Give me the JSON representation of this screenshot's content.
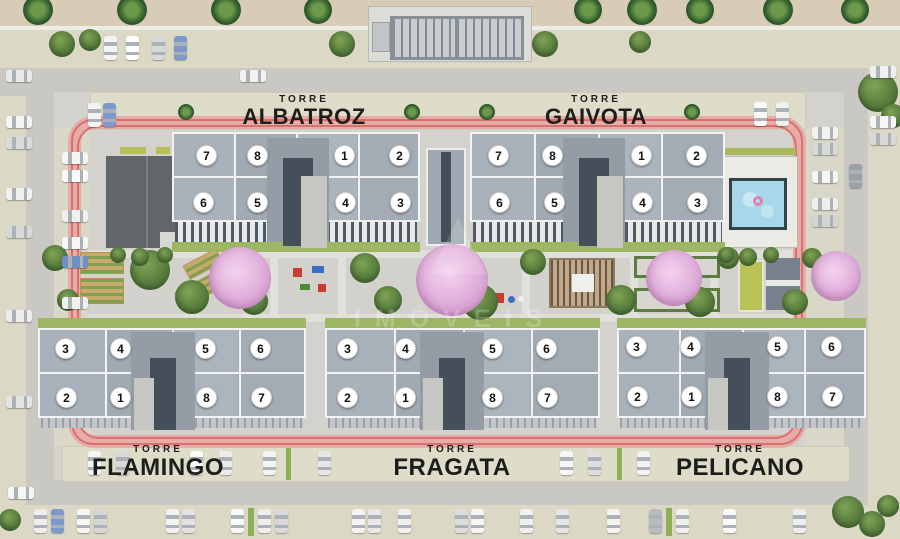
{
  "towers": [
    {
      "prefix": "TORRE",
      "name": "ALBATROZ",
      "row1": [
        "7",
        "8",
        "1",
        "2"
      ],
      "row2": [
        "6",
        "5",
        "4",
        "3"
      ]
    },
    {
      "prefix": "TORRE",
      "name": "GAIVOTA",
      "row1": [
        "7",
        "8",
        "1",
        "2"
      ],
      "row2": [
        "6",
        "5",
        "4",
        "3"
      ]
    },
    {
      "prefix": "TORRE",
      "name": "FLAMINGO",
      "row1": [
        "3",
        "4",
        "5",
        "6"
      ],
      "row2": [
        "2",
        "1",
        "8",
        "7"
      ]
    },
    {
      "prefix": "TORRE",
      "name": "FRAGATA",
      "row1": [
        "3",
        "4",
        "5",
        "6"
      ],
      "row2": [
        "2",
        "1",
        "8",
        "7"
      ]
    },
    {
      "prefix": "TORRE",
      "name": "PELICANO",
      "row1": [
        "3",
        "4",
        "5",
        "6"
      ],
      "row2": [
        "2",
        "1",
        "8",
        "7"
      ]
    }
  ],
  "watermark": {
    "text": "IMÓVEIS"
  },
  "amenities": [
    {
      "name": "swimming-pool"
    },
    {
      "name": "running-track"
    },
    {
      "name": "pergola-lounge"
    },
    {
      "name": "playground"
    },
    {
      "name": "community-garden"
    },
    {
      "name": "sport-court"
    },
    {
      "name": "entrance-gate"
    },
    {
      "name": "clubhouse"
    }
  ],
  "colors": {
    "track": "#e9aba8",
    "track_stripe": "#d6726d",
    "roof": "#a6aeb7",
    "pink_tree": "#d89fd2",
    "pool_water": "#a7d7e8",
    "lawn": "#9cb663",
    "road": "#cac8c3",
    "sidewalk": "#dbd8c5"
  }
}
